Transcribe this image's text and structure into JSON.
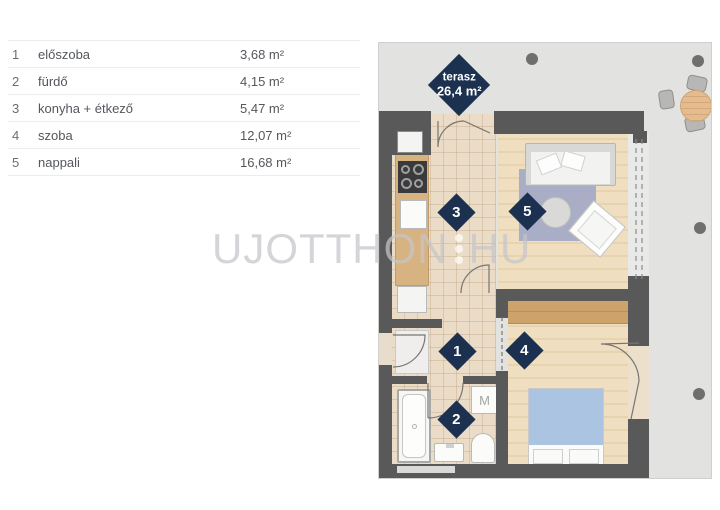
{
  "legend": {
    "rows": [
      {
        "num": "1",
        "name": "előszoba",
        "area": "3,68 m²"
      },
      {
        "num": "2",
        "name": "fürdő",
        "area": "4,15 m²"
      },
      {
        "num": "3",
        "name": "konyha + étkező",
        "area": "5,47 m²"
      },
      {
        "num": "4",
        "name": "szoba",
        "area": "12,07 m²"
      },
      {
        "num": "5",
        "name": "nappali",
        "area": "16,68 m²"
      }
    ]
  },
  "plan": {
    "terrace_label": {
      "title": "terasz",
      "area": "26,4 m²"
    },
    "room_markers": [
      "1",
      "2",
      "3",
      "4",
      "5"
    ],
    "washing_machine_label": "M"
  },
  "watermark": {
    "left": "UJOTTHON",
    "right": "HU"
  },
  "colors": {
    "navy": "#1c3150",
    "wall": "#59595a",
    "terrace": "#e2e2e0",
    "tile": "#ebdcc7",
    "wood": "#efdfc0",
    "counter": "#d8b382",
    "wardrobe": "#cda26b",
    "rug": "#a9aec6",
    "bed": "#abc4e2",
    "text": "#54575c",
    "watermark": "#c5c5cb"
  }
}
